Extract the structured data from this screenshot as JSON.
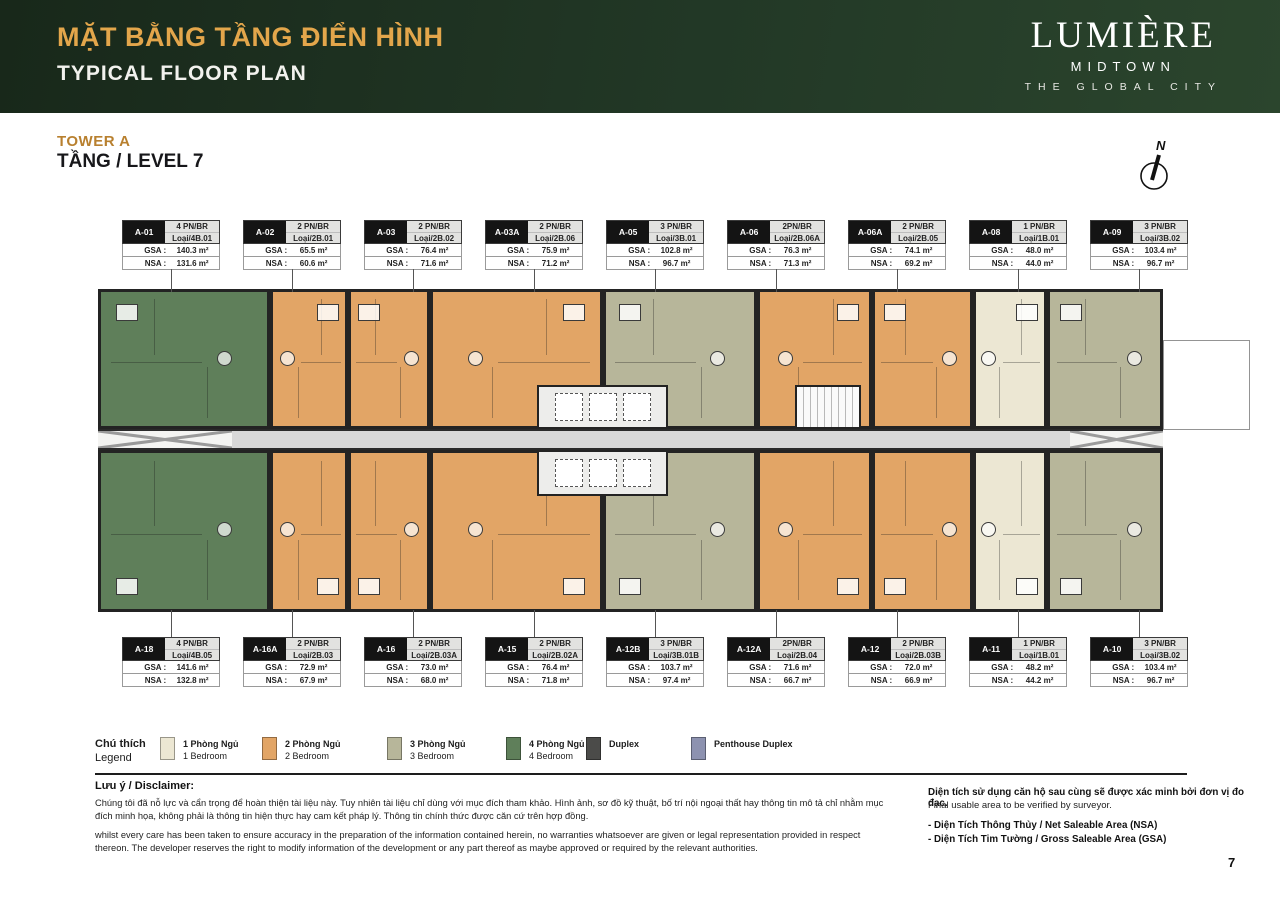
{
  "header": {
    "title_vi": "MẶT BẰNG TẦNG ĐIỂN HÌNH",
    "title_en": "TYPICAL FLOOR PLAN",
    "brand": {
      "name": "LUMIÈRE",
      "sub": "MIDTOWN",
      "tagline": "THE GLOBAL CITY"
    }
  },
  "tower": {
    "label": "TOWER A",
    "level": "TẦNG / LEVEL 7"
  },
  "compass": {
    "label": "N"
  },
  "table_labels": {
    "gsa": "GSA :",
    "nsa": "NSA :"
  },
  "units_top": [
    {
      "id": "A-01",
      "type": "4 PN/BR",
      "loai": "Loại/4B.01",
      "gsa": "140.3 m²",
      "nsa": "131.6 m²",
      "bed": "4"
    },
    {
      "id": "A-02",
      "type": "2 PN/BR",
      "loai": "Loại/2B.01",
      "gsa": "65.5 m²",
      "nsa": "60.6 m²",
      "bed": "2"
    },
    {
      "id": "A-03",
      "type": "2 PN/BR",
      "loai": "Loại/2B.02",
      "gsa": "76.4 m²",
      "nsa": "71.6 m²",
      "bed": "2"
    },
    {
      "id": "A-03A",
      "type": "2 PN/BR",
      "loai": "Loại/2B.06",
      "gsa": "75.9 m²",
      "nsa": "71.2 m²",
      "bed": "2"
    },
    {
      "id": "A-05",
      "type": "3 PN/BR",
      "loai": "Loại/3B.01",
      "gsa": "102.8 m²",
      "nsa": "96.7 m²",
      "bed": "3"
    },
    {
      "id": "A-06",
      "type": "2PN/BR",
      "loai": "Loại/2B.06A",
      "gsa": "76.3 m²",
      "nsa": "71.3 m²",
      "bed": "2"
    },
    {
      "id": "A-06A",
      "type": "2 PN/BR",
      "loai": "Loại/2B.05",
      "gsa": "74.1 m²",
      "nsa": "69.2 m²",
      "bed": "2"
    },
    {
      "id": "A-08",
      "type": "1 PN/BR",
      "loai": "Loại/1B.01",
      "gsa": "48.0 m²",
      "nsa": "44.0 m²",
      "bed": "1"
    },
    {
      "id": "A-09",
      "type": "3 PN/BR",
      "loai": "Loại/3B.02",
      "gsa": "103.4 m²",
      "nsa": "96.7 m²",
      "bed": "3"
    }
  ],
  "units_bottom": [
    {
      "id": "A-18",
      "type": "4 PN/BR",
      "loai": "Loại/4B.05",
      "gsa": "141.6 m²",
      "nsa": "132.8 m²",
      "bed": "4"
    },
    {
      "id": "A-16A",
      "type": "2 PN/BR",
      "loai": "Loại/2B.03",
      "gsa": "72.9 m²",
      "nsa": "67.9 m²",
      "bed": "2"
    },
    {
      "id": "A-16",
      "type": "2 PN/BR",
      "loai": "Loại/2B.03A",
      "gsa": "73.0 m²",
      "nsa": "68.0 m²",
      "bed": "2"
    },
    {
      "id": "A-15",
      "type": "2 PN/BR",
      "loai": "Loại/2B.02A",
      "gsa": "76.4 m²",
      "nsa": "71.8 m²",
      "bed": "2"
    },
    {
      "id": "A-12B",
      "type": "3 PN/BR",
      "loai": "Loại/3B.01B",
      "gsa": "103.7 m²",
      "nsa": "97.4 m²",
      "bed": "3"
    },
    {
      "id": "A-12A",
      "type": "2PN/BR",
      "loai": "Loại/2B.04",
      "gsa": "71.6 m²",
      "nsa": "66.7 m²",
      "bed": "2"
    },
    {
      "id": "A-12",
      "type": "2 PN/BR",
      "loai": "Loại/2B.03B",
      "gsa": "72.0 m²",
      "nsa": "66.9 m²",
      "bed": "2"
    },
    {
      "id": "A-11",
      "type": "1 PN/BR",
      "loai": "Loại/1B.01",
      "gsa": "48.2 m²",
      "nsa": "44.2 m²",
      "bed": "1"
    },
    {
      "id": "A-10",
      "type": "3 PN/BR",
      "loai": "Loại/3B.02",
      "gsa": "103.4 m²",
      "nsa": "96.7 m²",
      "bed": "3"
    }
  ],
  "legend": {
    "title_vi": "Chú thích",
    "title_en": "Legend",
    "items": [
      {
        "vi": "1 Phòng Ngủ",
        "en": "1 Bedroom",
        "key": "1"
      },
      {
        "vi": "2 Phòng Ngủ",
        "en": "2 Bedroom",
        "key": "2"
      },
      {
        "vi": "3 Phòng Ngủ",
        "en": "3 Bedroom",
        "key": "3"
      },
      {
        "vi": "4 Phòng Ngủ",
        "en": "4 Bedroom",
        "key": "4"
      },
      {
        "vi": "Duplex",
        "en": "",
        "key": "duplex"
      },
      {
        "vi": "Penthouse Duplex",
        "en": "",
        "key": "penthouse"
      }
    ]
  },
  "disclaimer": {
    "heading": "Lưu ý / Disclaimer:",
    "vi": "Chúng tôi đã nỗ lực và cẩn trọng để hoàn thiện tài liệu này. Tuy nhiên tài liệu chỉ dùng với mục đích tham khảo. Hình ảnh, sơ đồ kỹ thuật, bố trí nội ngoại thất hay thông tin mô tả chỉ nhằm mục đích minh họa, không phải là thông tin hiện thực hay cam kết pháp lý. Thông tin chính thức được căn cứ trên hợp đồng.",
    "en": "whilst every care has been taken to ensure accuracy in the preparation of the information contained herein, no warranties whatsoever are given or legal representation provided in respect thereon. The developer reserves the right to modify information of the development or any part thereof as maybe approved or required by the relevant authorities."
  },
  "area_note": {
    "vi": "Diện tích sử dụng căn hộ sau cùng sẽ được xác minh bởi đơn vị đo đạc.",
    "en": "Final usable area to be verified by surveyor.",
    "bullet1": "-  Diện Tích Thông Thủy / Net Saleable Area (NSA)",
    "bullet2": "-  Diện Tích Tim Tường / Gross Saleable Area (GSA)"
  },
  "page_number": "7",
  "colors": {
    "1": "#ece7d3",
    "2": "#e2a566",
    "3": "#b7b69a",
    "4": "#5f7f5a",
    "duplex": "#4b4b49",
    "penthouse": "#8d92b0",
    "corridor": "#d8d8d8",
    "wall": "#232323",
    "header_bg": "#223826",
    "gold": "#e3a64b",
    "tower_gold": "#b8802f"
  }
}
